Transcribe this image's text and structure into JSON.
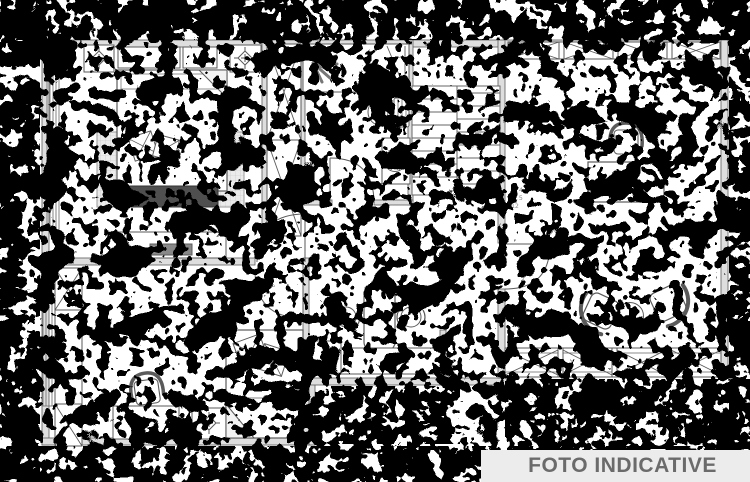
{
  "watermark": {
    "text": "FOTO INDICATIVE",
    "background": "#ececec",
    "color": "#6b6b6b"
  },
  "plan": {
    "type": "apartment-floor-plan-scan",
    "colors": {
      "paper": "#ffffff",
      "line": "#5a5a5a",
      "wall_fill": "#dedede",
      "noise": "#000000",
      "dark_blanket": "#4f4f4f",
      "rug": "#ebebeb"
    },
    "stair_note": {
      "lines": [
        "3,4",
        "0,5",
        "12"
      ]
    },
    "symbols": [
      "double-bed",
      "single-bed",
      "nightstand",
      "lamp",
      "wardrobe",
      "dresser-tv",
      "radiator",
      "shower",
      "toilet",
      "washbasin",
      "staircase",
      "desk",
      "desk-chair",
      "armchair",
      "round-side-table",
      "stool",
      "high-table",
      "counter",
      "window-x-strip",
      "door-arc"
    ]
  }
}
